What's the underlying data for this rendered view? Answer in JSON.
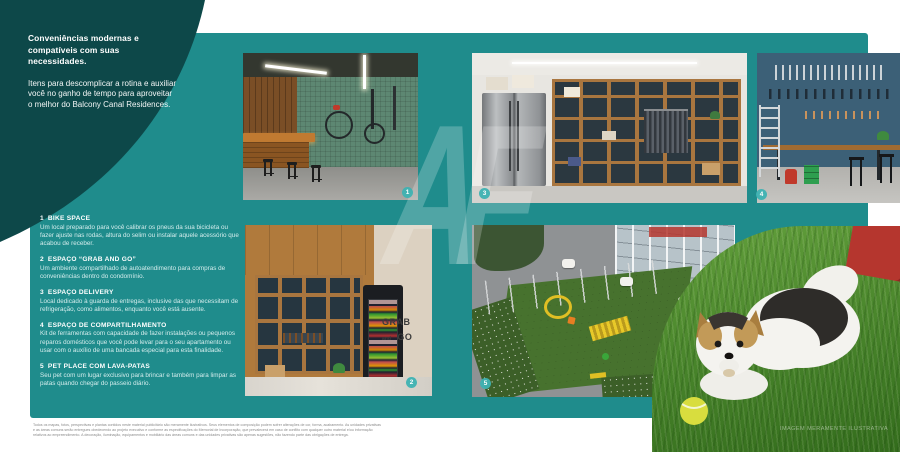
{
  "colors": {
    "panel_teal": "#1f8c8c",
    "corner_dark_teal": "#0d4849",
    "badge_teal": "#3eb2b2",
    "text_white": "#ffffff",
    "disclaimer_gray": "#8a8a8a"
  },
  "intro": {
    "heading": "Conveniências modernas e compatíveis com suas necessidades.",
    "body": "Itens para descomplicar a rotina e auxiliar você no ganho de tempo para aproveitar o melhor do Balcony Canal Residences."
  },
  "amenities": {
    "items": [
      {
        "number": "1",
        "title": "BIKE SPACE",
        "description": "Um local preparado para você calibrar os pneus da sua bicicleta ou fazer ajuste nas rodas, altura do selim ou instalar aquele acessório que acabou de receber."
      },
      {
        "number": "2",
        "title": "ESPAÇO “GRAB AND GO”",
        "description": "Um ambiente compartilhado de autoatendimento para compras de conveniências dentro do condomínio."
      },
      {
        "number": "3",
        "title": "ESPAÇO DELIVERY",
        "description": "Local dedicado à guarda de entregas, inclusive das que necessitam de refrigeração, como alimentos, enquanto você está ausente."
      },
      {
        "number": "4",
        "title": "ESPAÇO DE COMPARTILHAMENTO",
        "description": "Kit de ferramentas com capacidade de fazer instalações ou pequenos reparos domésticos que você pode levar para o seu apartamento ou usar com o auxílio de uma bancada especial para esta finalidade."
      },
      {
        "number": "5",
        "title": "PET PLACE COM LAVA-PATAS",
        "description": "Seu pet com um lugar exclusivo para brincar e também para limpar as patas quando chegar do passeio diário."
      }
    ]
  },
  "photo_badges": {
    "bike_space": "1",
    "grab_and_go": "2",
    "delivery": "3",
    "compartilhamento": "4",
    "pet_place": "5"
  },
  "grab_and_go_sign": {
    "line1": "GRAB",
    "line2": "and",
    "line3": "GO"
  },
  "watermark": "AF",
  "photo_credit": "IMAGEM MERAMENTE ILUSTRATIVA",
  "disclaimer": "Todos os mapas, fotos, perspectivas e plantas contidos neste material publicitário são meramente ilustrativos. Seus elementos de composição podem sofrer alterações de cor, forma, acabamento. As unidades privativas e as áreas comuns serão entregues obedecendo ao projeto executivo e conforme as especificações do Memorial de Incorporação, que prevalecerá em caso de conflito com qualquer outro material e/ou informação relativos ao empreendimento. A decoração, iluminação, equipamentos e mobiliário das áreas comuns e das unidades privativas são apenas sugestões, não fazendo parte das obrigações de entrega."
}
